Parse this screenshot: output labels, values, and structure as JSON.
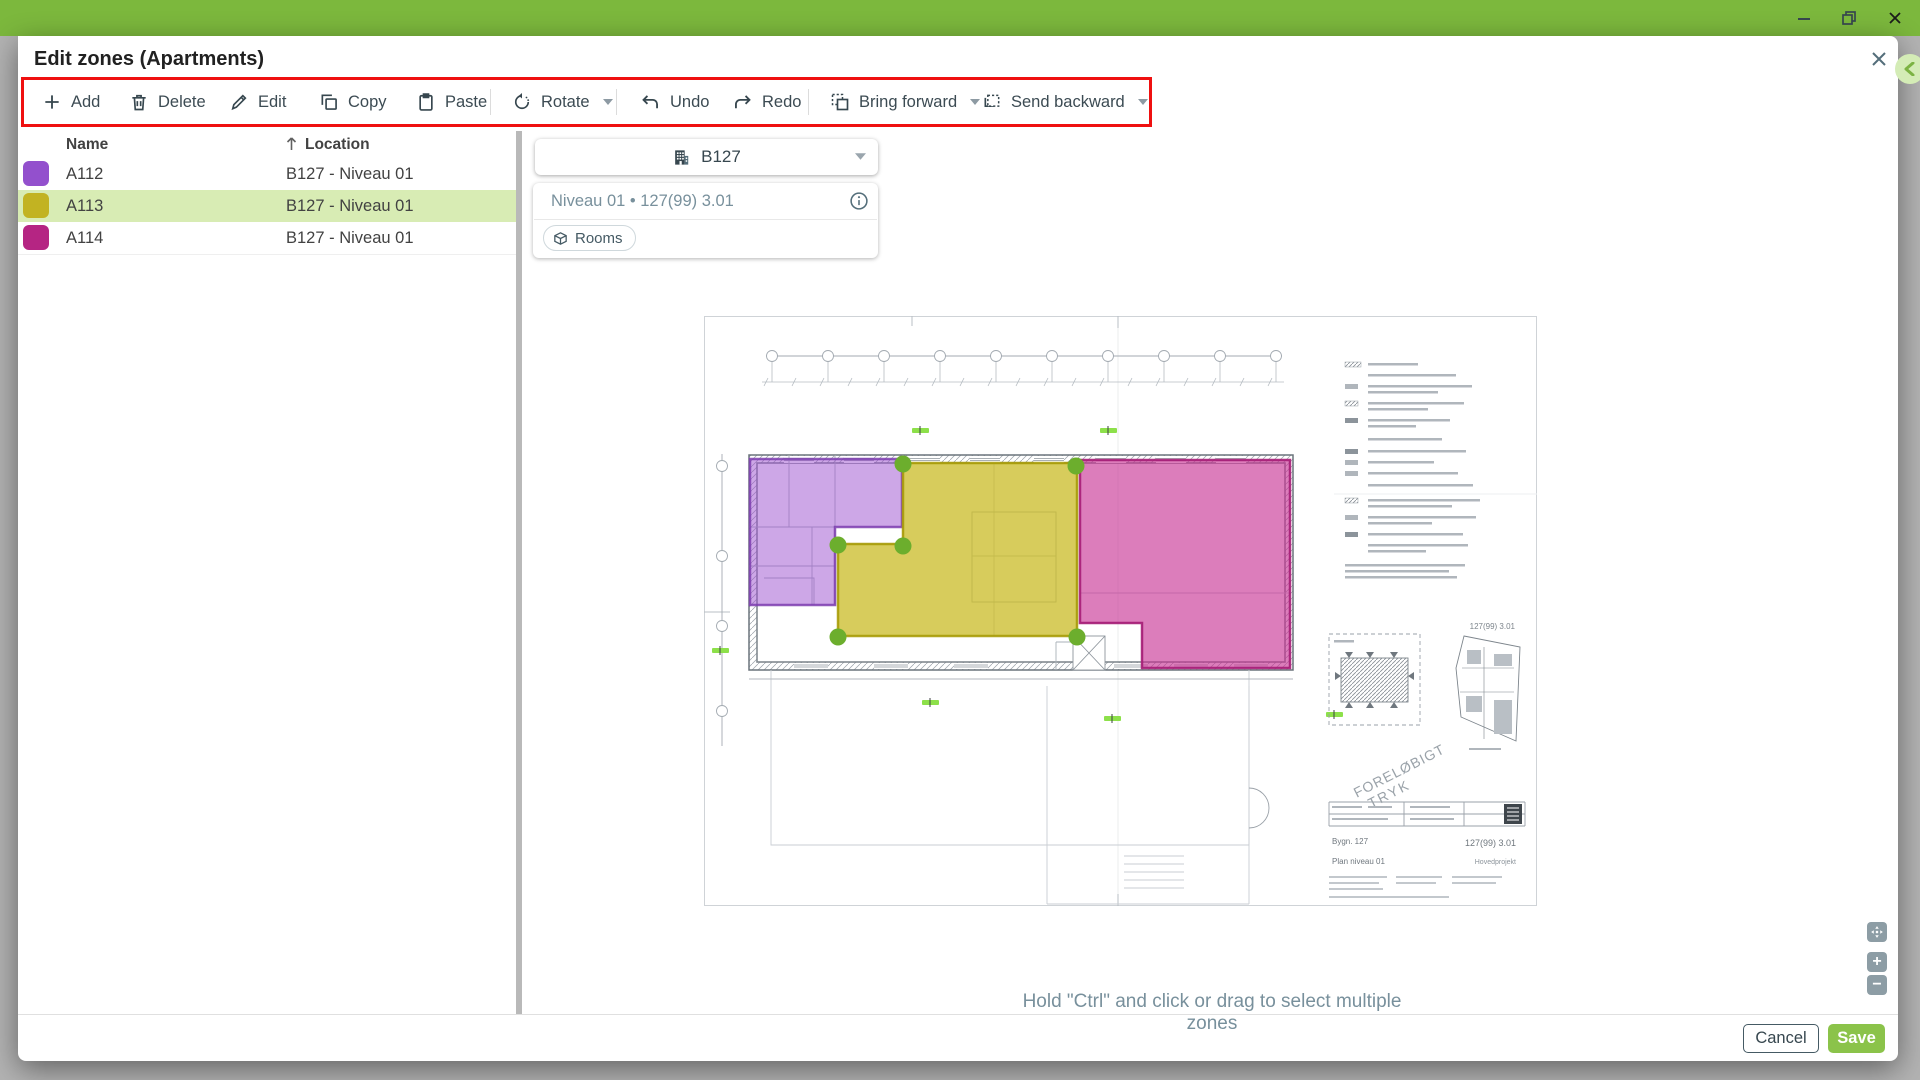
{
  "window": {
    "titlebar_color": "#7cb83d",
    "controls": {
      "minimize": "minimize",
      "restore": "restore",
      "close": "close"
    }
  },
  "dialog": {
    "title": "Edit zones (Apartments)",
    "highlight_color": "#ef1010"
  },
  "toolbar": {
    "buttons": [
      {
        "label": "Add",
        "icon": "plus"
      },
      {
        "label": "Delete",
        "icon": "trash"
      },
      {
        "label": "Edit",
        "icon": "pencil"
      },
      {
        "label": "Copy",
        "icon": "copy"
      },
      {
        "label": "Paste",
        "icon": "clipboard"
      },
      {
        "label": "Rotate",
        "icon": "rotate",
        "dropdown": true
      },
      {
        "label": "Undo",
        "icon": "undo"
      },
      {
        "label": "Redo",
        "icon": "redo"
      },
      {
        "label": "Bring forward",
        "icon": "bring-forward",
        "dropdown": true
      },
      {
        "label": "Send backward",
        "icon": "send-backward",
        "dropdown": true
      }
    ]
  },
  "zone_table": {
    "columns": {
      "name": "Name",
      "location": "Location"
    },
    "sort": {
      "column": "Location",
      "direction": "asc"
    },
    "selected_row_color": "#d8ecb4",
    "rows": [
      {
        "name": "A112",
        "location": "B127 - Niveau 01",
        "color": "#9350cd",
        "selected": false
      },
      {
        "name": "A113",
        "location": "B127 - Niveau 01",
        "color": "#c2b322",
        "selected": true
      },
      {
        "name": "A114",
        "location": "B127 - Niveau 01",
        "color": "#b52583",
        "selected": false
      }
    ]
  },
  "canvas": {
    "building_selector": {
      "value": "B127"
    },
    "level_card": {
      "label": "Niveau 01 • 127(99) 3.01",
      "chip_label": "Rooms"
    },
    "hint": "Hold \"Ctrl\" and click or drag to select multiple zones",
    "zoom_controls": {
      "zoom_in": "+",
      "zoom_out": "−"
    },
    "plan": {
      "handle_color": "#6cae2d",
      "zones": [
        {
          "name": "A112",
          "color": "#9b4fd0",
          "stroke": "#7c3daf"
        },
        {
          "name": "A113",
          "color": "#c6b717",
          "stroke": "#a99c08"
        },
        {
          "name": "A114",
          "color": "#c62d92",
          "stroke": "#a61d77"
        }
      ],
      "labels": {
        "drawing_number_margin": "127(99) 3.01",
        "watermark_line1": "FORELØBIGT",
        "watermark_line2": "TRYK",
        "title_block_building": "Bygn. 127",
        "title_block_plan": "Plan niveau 01",
        "title_block_number": "127(99) 3.01",
        "title_block_type": "Hovedprojekt"
      }
    }
  },
  "footer": {
    "cancel_label": "Cancel",
    "save_label": "Save",
    "save_color": "#8bc34a"
  }
}
